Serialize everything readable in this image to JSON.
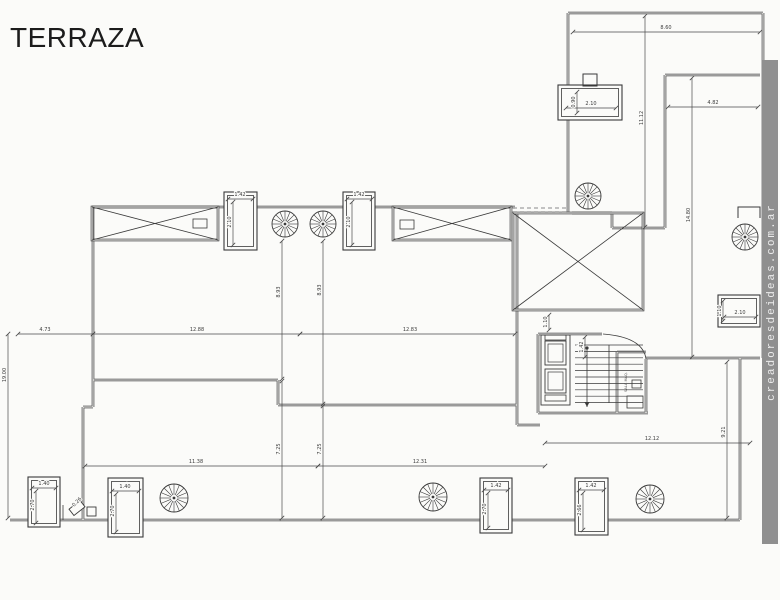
{
  "page": {
    "title": "TERRAZA",
    "watermark": "creadoresdeideas.com.ar",
    "background": "#fbfbf9",
    "line_color": "#3a3a3a",
    "watermark_bar_color": "#8f8f8f"
  },
  "plan": {
    "machine_room_label": "SALA MAQ.",
    "dimensions": [
      {
        "value": "8.60",
        "x1": 573,
        "y1": 32,
        "x2": 760,
        "y2": 32,
        "lx": 666,
        "ly": 29,
        "rot": 0
      },
      {
        "value": "4.82",
        "x1": 668,
        "y1": 107,
        "x2": 758,
        "y2": 107,
        "lx": 713,
        "ly": 104,
        "rot": 0
      },
      {
        "value": "11.12",
        "x1": 645,
        "y1": 16,
        "x2": 645,
        "y2": 227,
        "lx": 643,
        "ly": 118,
        "rot": -90
      },
      {
        "value": "14.80",
        "x1": 692,
        "y1": 78,
        "x2": 692,
        "y2": 357,
        "lx": 690,
        "ly": 215,
        "rot": -90
      },
      {
        "value": "2.10",
        "x1": 566,
        "y1": 108,
        "x2": 616,
        "y2": 108,
        "lx": 591,
        "ly": 105,
        "rot": 0
      },
      {
        "value": "0.90",
        "x1": 577,
        "y1": 92,
        "x2": 577,
        "y2": 113,
        "lx": 575,
        "ly": 102,
        "rot": -90
      },
      {
        "value": "2.10",
        "x1": 724,
        "y1": 317,
        "x2": 756,
        "y2": 317,
        "lx": 740,
        "ly": 314,
        "rot": 0
      },
      {
        "value": "1.10",
        "x1": 723,
        "y1": 301,
        "x2": 723,
        "y2": 321,
        "lx": 721,
        "ly": 311,
        "rot": -90
      },
      {
        "value": "1.42",
        "x1": 228,
        "y1": 199,
        "x2": 253,
        "y2": 199,
        "lx": 240,
        "ly": 196,
        "rot": 0
      },
      {
        "value": "2.10",
        "x1": 233,
        "y1": 202,
        "x2": 233,
        "y2": 245,
        "lx": 231,
        "ly": 222,
        "rot": -90
      },
      {
        "value": "1.42",
        "x1": 347,
        "y1": 199,
        "x2": 372,
        "y2": 199,
        "lx": 359,
        "ly": 196,
        "rot": 0
      },
      {
        "value": "2.10",
        "x1": 352,
        "y1": 202,
        "x2": 352,
        "y2": 245,
        "lx": 350,
        "ly": 222,
        "rot": -90
      },
      {
        "value": "8.93",
        "x1": 282,
        "y1": 241,
        "x2": 282,
        "y2": 379,
        "lx": 280,
        "ly": 292,
        "rot": -90
      },
      {
        "value": "8.93",
        "x1": 323,
        "y1": 241,
        "x2": 323,
        "y2": 404,
        "lx": 321,
        "ly": 290,
        "rot": -90
      },
      {
        "value": "7.25",
        "x1": 282,
        "y1": 381,
        "x2": 282,
        "y2": 518,
        "lx": 280,
        "ly": 449,
        "rot": -90
      },
      {
        "value": "7.25",
        "x1": 323,
        "y1": 406,
        "x2": 323,
        "y2": 518,
        "lx": 321,
        "ly": 449,
        "rot": -90
      },
      {
        "value": "4.73",
        "x1": 18,
        "y1": 334,
        "x2": 93,
        "y2": 334,
        "lx": 45,
        "ly": 331,
        "rot": 0
      },
      {
        "value": "12.88",
        "x1": 93,
        "y1": 334,
        "x2": 300,
        "y2": 334,
        "lx": 197,
        "ly": 331,
        "rot": 0
      },
      {
        "value": "12.83",
        "x1": 300,
        "y1": 334,
        "x2": 515,
        "y2": 334,
        "lx": 410,
        "ly": 331,
        "rot": 0
      },
      {
        "value": "19.00",
        "x1": 8,
        "y1": 334,
        "x2": 8,
        "y2": 518,
        "lx": 6,
        "ly": 375,
        "rot": -90
      },
      {
        "value": "11.38",
        "x1": 85,
        "y1": 466,
        "x2": 318,
        "y2": 466,
        "lx": 196,
        "ly": 463,
        "rot": 0
      },
      {
        "value": "12.31",
        "x1": 318,
        "y1": 466,
        "x2": 545,
        "y2": 466,
        "lx": 420,
        "ly": 463,
        "rot": 0
      },
      {
        "value": "12.12",
        "x1": 545,
        "y1": 443,
        "x2": 750,
        "y2": 443,
        "lx": 652,
        "ly": 440,
        "rot": 0
      },
      {
        "value": "9.21",
        "x1": 727,
        "y1": 362,
        "x2": 727,
        "y2": 518,
        "lx": 725,
        "ly": 432,
        "rot": -90
      },
      {
        "value": "1.10",
        "x1": 549,
        "y1": 315,
        "x2": 549,
        "y2": 330,
        "lx": 547,
        "ly": 322,
        "rot": -90
      },
      {
        "value": "1.42",
        "x1": 585,
        "y1": 337,
        "x2": 585,
        "y2": 357,
        "lx": 583,
        "ly": 347,
        "rot": -90
      },
      {
        "value": "1.40",
        "x1": 32,
        "y1": 488,
        "x2": 56,
        "y2": 488,
        "lx": 44,
        "ly": 485,
        "rot": 0
      },
      {
        "value": "2.70",
        "x1": 36,
        "y1": 491,
        "x2": 36,
        "y2": 523,
        "lx": 34,
        "ly": 505,
        "rot": -90
      },
      {
        "value": "1.40",
        "x1": 112,
        "y1": 491,
        "x2": 139,
        "y2": 491,
        "lx": 125,
        "ly": 488,
        "rot": 0
      },
      {
        "value": "2.70",
        "x1": 116,
        "y1": 494,
        "x2": 116,
        "y2": 532,
        "lx": 114,
        "ly": 511,
        "rot": -90
      },
      {
        "value": "1.42",
        "x1": 484,
        "y1": 490,
        "x2": 508,
        "y2": 490,
        "lx": 496,
        "ly": 487,
        "rot": 0
      },
      {
        "value": "2.70",
        "x1": 488,
        "y1": 493,
        "x2": 488,
        "y2": 528,
        "lx": 486,
        "ly": 509,
        "rot": -90
      },
      {
        "value": "1.42",
        "x1": 579,
        "y1": 490,
        "x2": 604,
        "y2": 490,
        "lx": 591,
        "ly": 487,
        "rot": 0
      },
      {
        "value": "2.66",
        "x1": 583,
        "y1": 493,
        "x2": 583,
        "y2": 530,
        "lx": 581,
        "ly": 510,
        "rot": -90
      },
      {
        "value": "0.26",
        "lx": 78,
        "ly": 503,
        "rot": -45
      }
    ],
    "spiral_stairs": [
      {
        "cx": 285,
        "cy": 224,
        "r": 13
      },
      {
        "cx": 323,
        "cy": 224,
        "r": 13
      },
      {
        "cx": 588,
        "cy": 196,
        "r": 13
      },
      {
        "cx": 745,
        "cy": 237,
        "r": 13
      },
      {
        "cx": 174,
        "cy": 498,
        "r": 14
      },
      {
        "cx": 433,
        "cy": 497,
        "r": 14
      },
      {
        "cx": 650,
        "cy": 499,
        "r": 14
      }
    ],
    "skylights": [
      {
        "x": 92,
        "y": 207,
        "w": 126,
        "h": 33,
        "tab": {
          "x": 193,
          "y": 219,
          "w": 14,
          "h": 9
        }
      },
      {
        "x": 393,
        "y": 207,
        "w": 118,
        "h": 33,
        "tab": {
          "x": 400,
          "y": 220,
          "w": 14,
          "h": 9
        }
      },
      {
        "x": 513,
        "y": 213,
        "w": 130,
        "h": 97
      }
    ],
    "vent_boxes": [
      {
        "x": 224,
        "y": 192,
        "w": 33,
        "h": 58
      },
      {
        "x": 343,
        "y": 192,
        "w": 32,
        "h": 58
      },
      {
        "x": 558,
        "y": 85,
        "w": 64,
        "h": 35
      },
      {
        "x": 718,
        "y": 295,
        "w": 42,
        "h": 32
      },
      {
        "x": 28,
        "y": 477,
        "w": 32,
        "h": 50
      },
      {
        "x": 108,
        "y": 478,
        "w": 35,
        "h": 59
      },
      {
        "x": 480,
        "y": 478,
        "w": 32,
        "h": 55
      },
      {
        "x": 575,
        "y": 478,
        "w": 33,
        "h": 57
      }
    ]
  }
}
